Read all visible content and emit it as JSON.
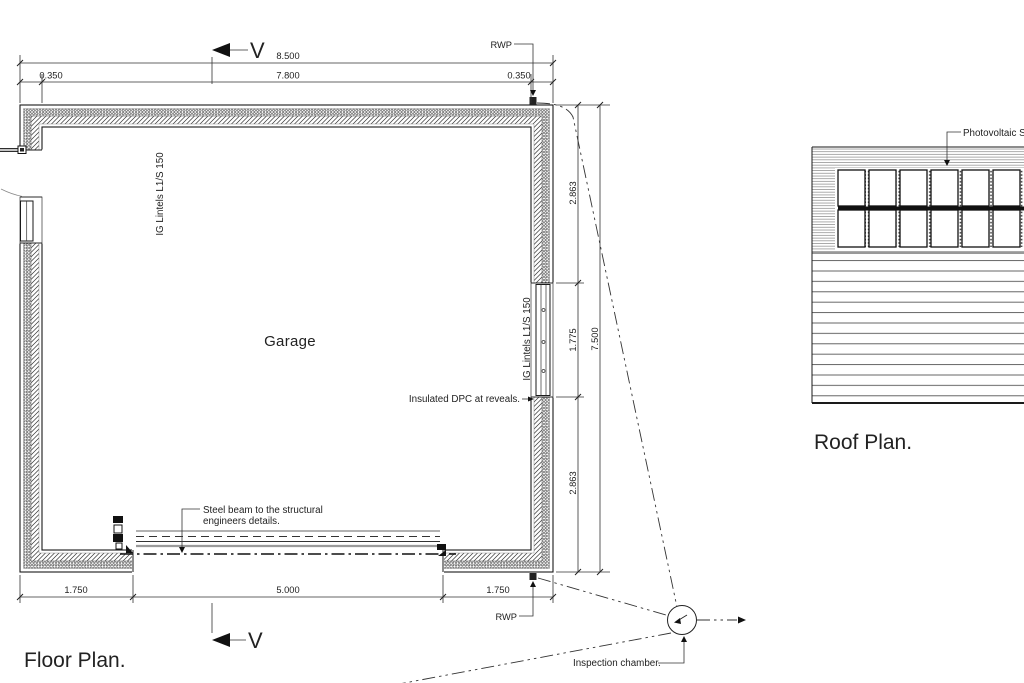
{
  "floor_plan": {
    "title": "Floor Plan.",
    "room_label": "Garage",
    "section_letter": "V",
    "rwp_label": "RWP",
    "lintel_label": "IG Lintels L1/S 150",
    "dpc_label": "Insulated DPC at reveals.",
    "beam_label_line1": "Steel beam to the structural",
    "beam_label_line2": "engineers details.",
    "chamber_label": "Inspection chamber.",
    "dims": {
      "overall_width": "8.500",
      "wall_left": "0.350",
      "clear_width": "7.800",
      "wall_right": "0.350",
      "right_seg_top": "2.863",
      "right_seg_mid": "1.775",
      "right_seg_bottom": "2.863",
      "overall_depth": "7.500",
      "bottom_seg_left": "1.750",
      "door_width": "5.000",
      "bottom_seg_right": "1.750"
    }
  },
  "roof_plan": {
    "title": "Roof Plan.",
    "pv_label": "Photovoltaic Sola",
    "panels": {
      "rows": 2,
      "columns": 6
    }
  }
}
